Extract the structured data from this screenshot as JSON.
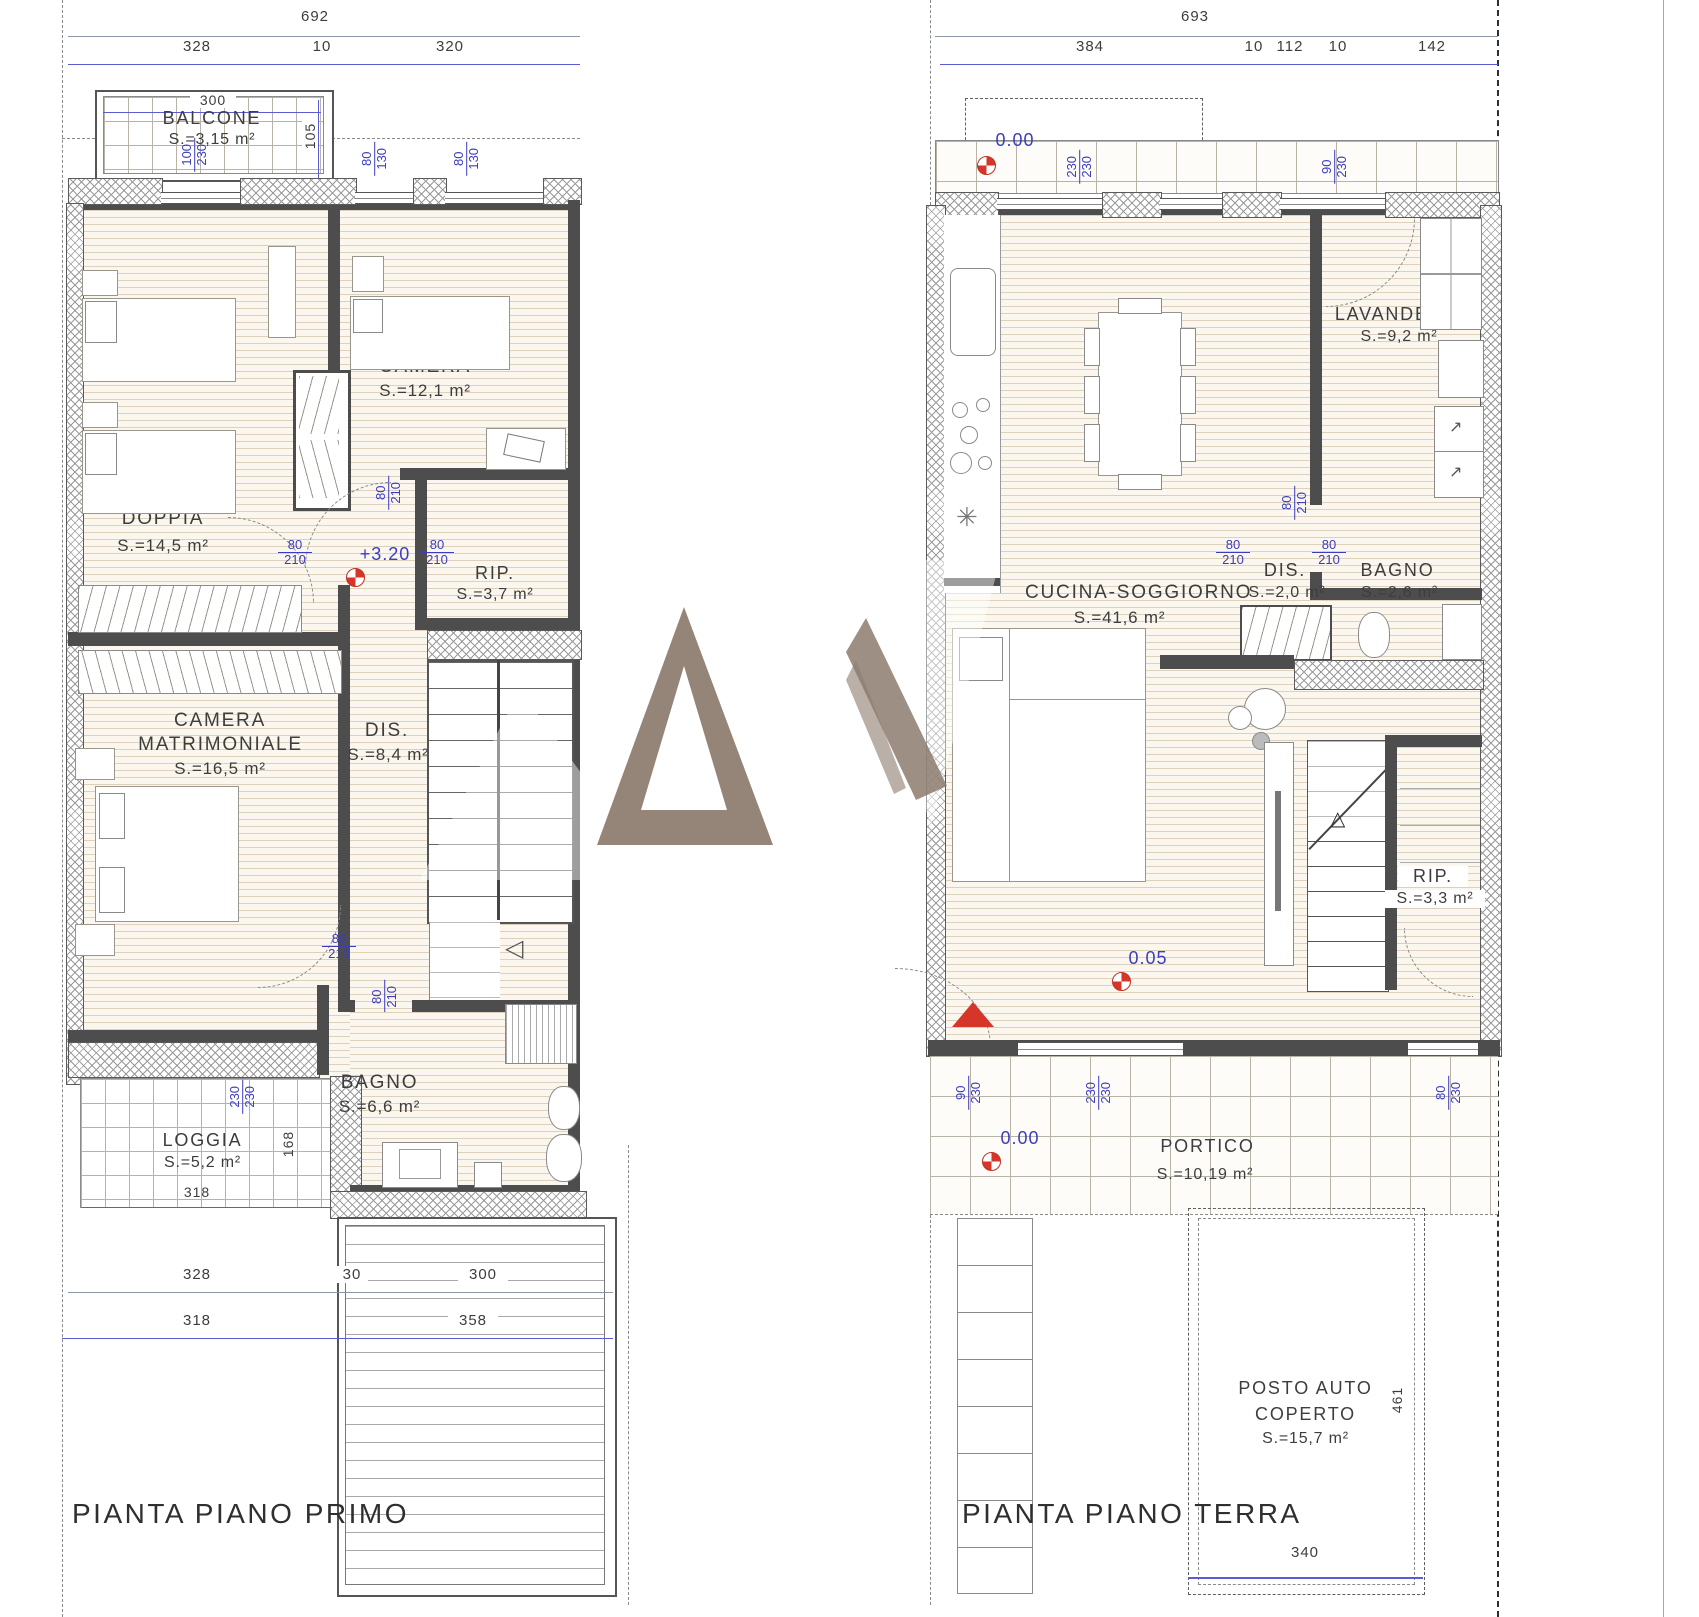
{
  "fr": {
    "n80": "80",
    "n90": "90",
    "n100": "100",
    "n130": "130",
    "n230": "230",
    "d70": "70",
    "d130": "130",
    "d210": "210",
    "d230": "230"
  },
  "icons": {
    "snowflake": "✳",
    "stairs_arrow_left": "◁",
    "stairs_arrow_up": "△",
    "washer_arrow": "↗"
  },
  "plans": {
    "primo": {
      "title": "PIANTA PIANO PRIMO",
      "levels": {
        "floor": "+3.20"
      },
      "dims": {
        "total": "692",
        "seg1": "328",
        "seg2": "10",
        "seg3": "320",
        "balcony_w": "300",
        "balcony_h": "105",
        "loggia_w": "318",
        "loggia_h": "168",
        "bottom1a": "328",
        "bottom1b": "30",
        "bottom1c": "300",
        "bottom2a": "318",
        "bottom2b": "358"
      },
      "rooms": {
        "balcone": {
          "name": "BALCONE",
          "area": "S.=3,15 m²"
        },
        "camera": {
          "name": "CAMERA",
          "area": "S.=12,1 m²"
        },
        "camera_doppia": {
          "name1": "CAMERA",
          "name2": "DOPPIA",
          "area": "S.=14,5 m²"
        },
        "camera_matrimoniale": {
          "name1": "CAMERA",
          "name2": "MATRIMONIALE",
          "area": "S.=16,5 m²"
        },
        "dis": {
          "name": "DIS.",
          "area": "S.=8,4 m²"
        },
        "rip": {
          "name": "RIP.",
          "area": "S.=3,7 m²"
        },
        "bagno": {
          "name": "BAGNO",
          "area": "S.=6,6 m²"
        },
        "loggia": {
          "name": "LOGGIA",
          "area": "S.=5,2 m²"
        }
      }
    },
    "terra": {
      "title": "PIANTA PIANO TERRA",
      "levels": {
        "ground": "0.00",
        "entry": "0.05",
        "portico": "0.00"
      },
      "dims": {
        "total": "693",
        "seg1": "384",
        "seg2": "10",
        "seg3": "112",
        "seg4": "10",
        "seg5": "142",
        "posto_w": "340",
        "posto_h": "461"
      },
      "rooms": {
        "cucina": {
          "name": "CUCINA-SOGGIORNO",
          "area": "S.=41,6 m²"
        },
        "lavanderia": {
          "name": "LAVANDERIA",
          "area": "S.=9,2 m²"
        },
        "dis": {
          "name": "DIS.",
          "area": "S.=2,0 m²"
        },
        "bagno": {
          "name": "BAGNO",
          "area": "S.=2,6 m²"
        },
        "rip": {
          "name": "RIP.",
          "area": "S.=3,3 m²"
        },
        "portico": {
          "name": "PORTICO",
          "area": "S.=10,19 m²"
        },
        "posto": {
          "name1": "POSTO AUTO",
          "name2": "COPERTO",
          "area": "S.=15,7 m²"
        }
      }
    }
  }
}
